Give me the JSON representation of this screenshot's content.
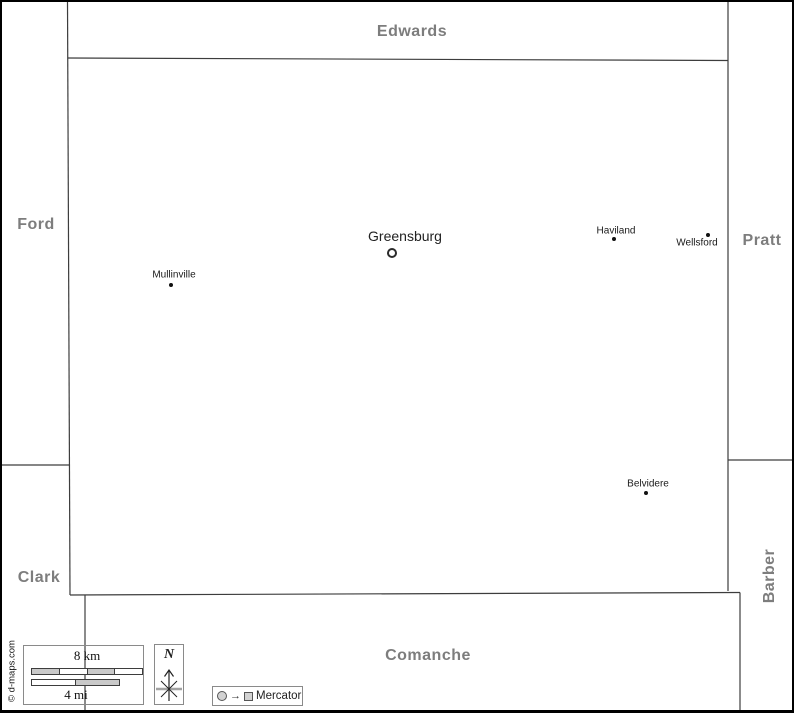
{
  "map_title": "Kiowa county map with neighboring counties",
  "regions": [
    {
      "label": "Edwards",
      "position": "top"
    },
    {
      "label": "Ford",
      "position": "left"
    },
    {
      "label": "Pratt",
      "position": "right"
    },
    {
      "label": "Clark",
      "position": "bottom-left"
    },
    {
      "label": "Barber",
      "position": "bottom-right-vertical"
    },
    {
      "label": "Comanche",
      "position": "bottom"
    }
  ],
  "cities": [
    {
      "name": "Greensburg",
      "marker": "ring",
      "role": "county-seat"
    },
    {
      "name": "Mullinville",
      "marker": "dot"
    },
    {
      "name": "Haviland",
      "marker": "dot"
    },
    {
      "name": "Wellsford",
      "marker": "dot"
    },
    {
      "name": "Belvidere",
      "marker": "dot"
    }
  ],
  "scale_bar": {
    "km_label": "8 km",
    "mi_label": "4 mi",
    "km_segments": [
      "gray",
      "white",
      "gray",
      "white"
    ],
    "mi_segments": [
      "white",
      "gray"
    ]
  },
  "north_indicator": {
    "label": "N"
  },
  "projection": {
    "label": "Mercator",
    "arrow_glyph": "→"
  },
  "copyright": "© d-maps.com",
  "colors": {
    "boundary_line": "#3d3d3d",
    "region_label": "#7d7d7d",
    "city_label": "#1a1a1a",
    "scale_gray": "#c9c9c9",
    "box_border": "#8a8a8a",
    "frame": "#000000"
  }
}
